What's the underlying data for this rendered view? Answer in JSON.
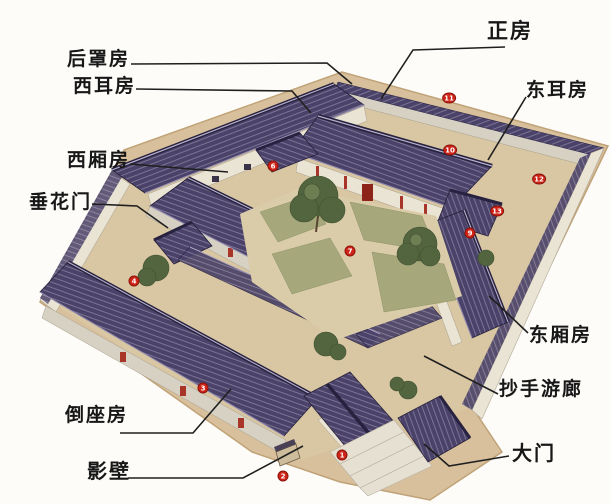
{
  "diagram": {
    "subject": "siheyuan-courtyard-house-annotated-illustration",
    "palette": {
      "bg": "#fdfcf9",
      "line": "#1f1f1f",
      "text": "#171717",
      "roof_mid": "#4a4268",
      "ridge": "#27223f",
      "ridge_cap": "#b7b0cc",
      "wall_cream": "#eae4d4",
      "wall_gray": "#d6d1c3",
      "platform": "#d8c09c",
      "platform_edge": "#c0a277",
      "path": "#dbcca9",
      "lawn": "#a6a77a",
      "tree": "#53653e",
      "accent_red": "#a93528",
      "badge": "#cf2418"
    },
    "labels": [
      {
        "id": "houzhaofang",
        "text": "后罩房",
        "x": 67,
        "y": 50,
        "font_size": 19,
        "line": "131,64 327,63 352,84"
      },
      {
        "id": "xierfang",
        "text": "西耳房",
        "x": 73,
        "y": 77,
        "font_size": 19,
        "line": "136,89 292,91 311,113"
      },
      {
        "id": "xixiangfang",
        "text": "西厢房",
        "x": 67,
        "y": 151,
        "font_size": 19,
        "line": "130,164 228,172"
      },
      {
        "id": "chuihuamen",
        "text": "垂花门",
        "x": 29,
        "y": 193,
        "font_size": 19,
        "line": "92,204 137,206 168,228"
      },
      {
        "id": "zhengfang",
        "text": "正房",
        "x": 487,
        "y": 21,
        "font_size": 21,
        "line": "505,47 413,50 381,99"
      },
      {
        "id": "dongerfang",
        "text": "东耳房",
        "x": 526,
        "y": 81,
        "font_size": 19,
        "line": "526,97 488,160"
      },
      {
        "id": "dongxiangfang",
        "text": "东厢房",
        "x": 529,
        "y": 326,
        "font_size": 19,
        "line": "528,333 489,296"
      },
      {
        "id": "chaoshouyoulang",
        "text": "抄手游廊",
        "x": 499,
        "y": 380,
        "font_size": 19,
        "line": "498,394 424,356"
      },
      {
        "id": "daozuofang",
        "text": "倒座房",
        "x": 65,
        "y": 406,
        "font_size": 19,
        "line": "120,433 193,433 231,389"
      },
      {
        "id": "yingbi",
        "text": "影壁",
        "x": 87,
        "y": 461,
        "font_size": 20,
        "line": "128,478 243,478 303,446"
      },
      {
        "id": "damen",
        "text": "大门",
        "x": 512,
        "y": 443,
        "font_size": 20,
        "line": "509,456 449,466 424,444"
      }
    ],
    "badges": [
      {
        "num": "1",
        "x": 342,
        "y": 455
      },
      {
        "num": "2",
        "x": 283,
        "y": 476
      },
      {
        "num": "3",
        "x": 203,
        "y": 388
      },
      {
        "num": "4",
        "x": 134,
        "y": 281
      },
      {
        "num": "6",
        "x": 273,
        "y": 166
      },
      {
        "num": "7",
        "x": 350,
        "y": 251
      },
      {
        "num": "9",
        "x": 470,
        "y": 233
      },
      {
        "num": "10",
        "x": 450,
        "y": 150
      },
      {
        "num": "11",
        "x": 449,
        "y": 98
      },
      {
        "num": "12",
        "x": 539,
        "y": 179
      },
      {
        "num": "13",
        "x": 497,
        "y": 211
      }
    ]
  }
}
